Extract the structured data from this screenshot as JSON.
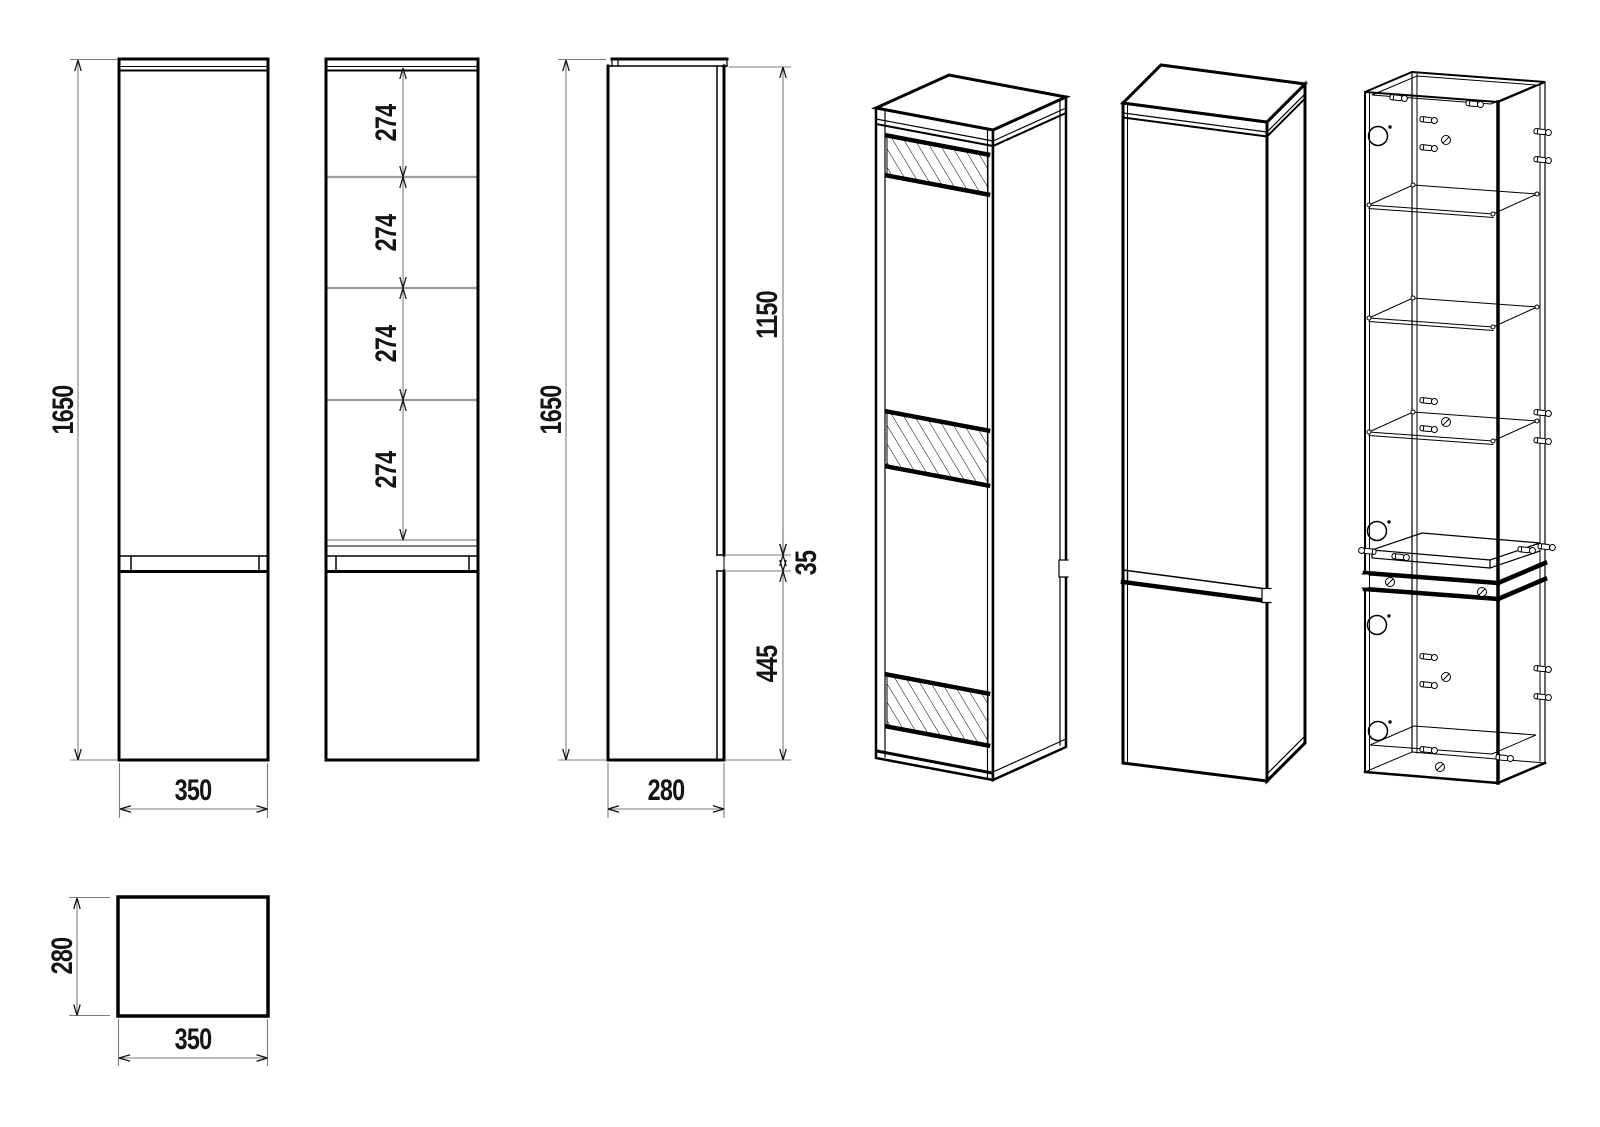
{
  "drawing": {
    "background": "#ffffff",
    "line_color": "#000000",
    "dim_line_color": "#7c7c7c",
    "shelf_line_color": "#9c9c9c",
    "dims": {
      "front_height": "1650",
      "front_width": "350",
      "shelf_spacing": [
        "274",
        "274",
        "274",
        "274"
      ],
      "side_height": "1650",
      "side_upper_section": "1150",
      "side_groove": "35",
      "side_lower_section": "445",
      "side_depth": "280",
      "top_depth": "280",
      "top_width": "350"
    }
  }
}
